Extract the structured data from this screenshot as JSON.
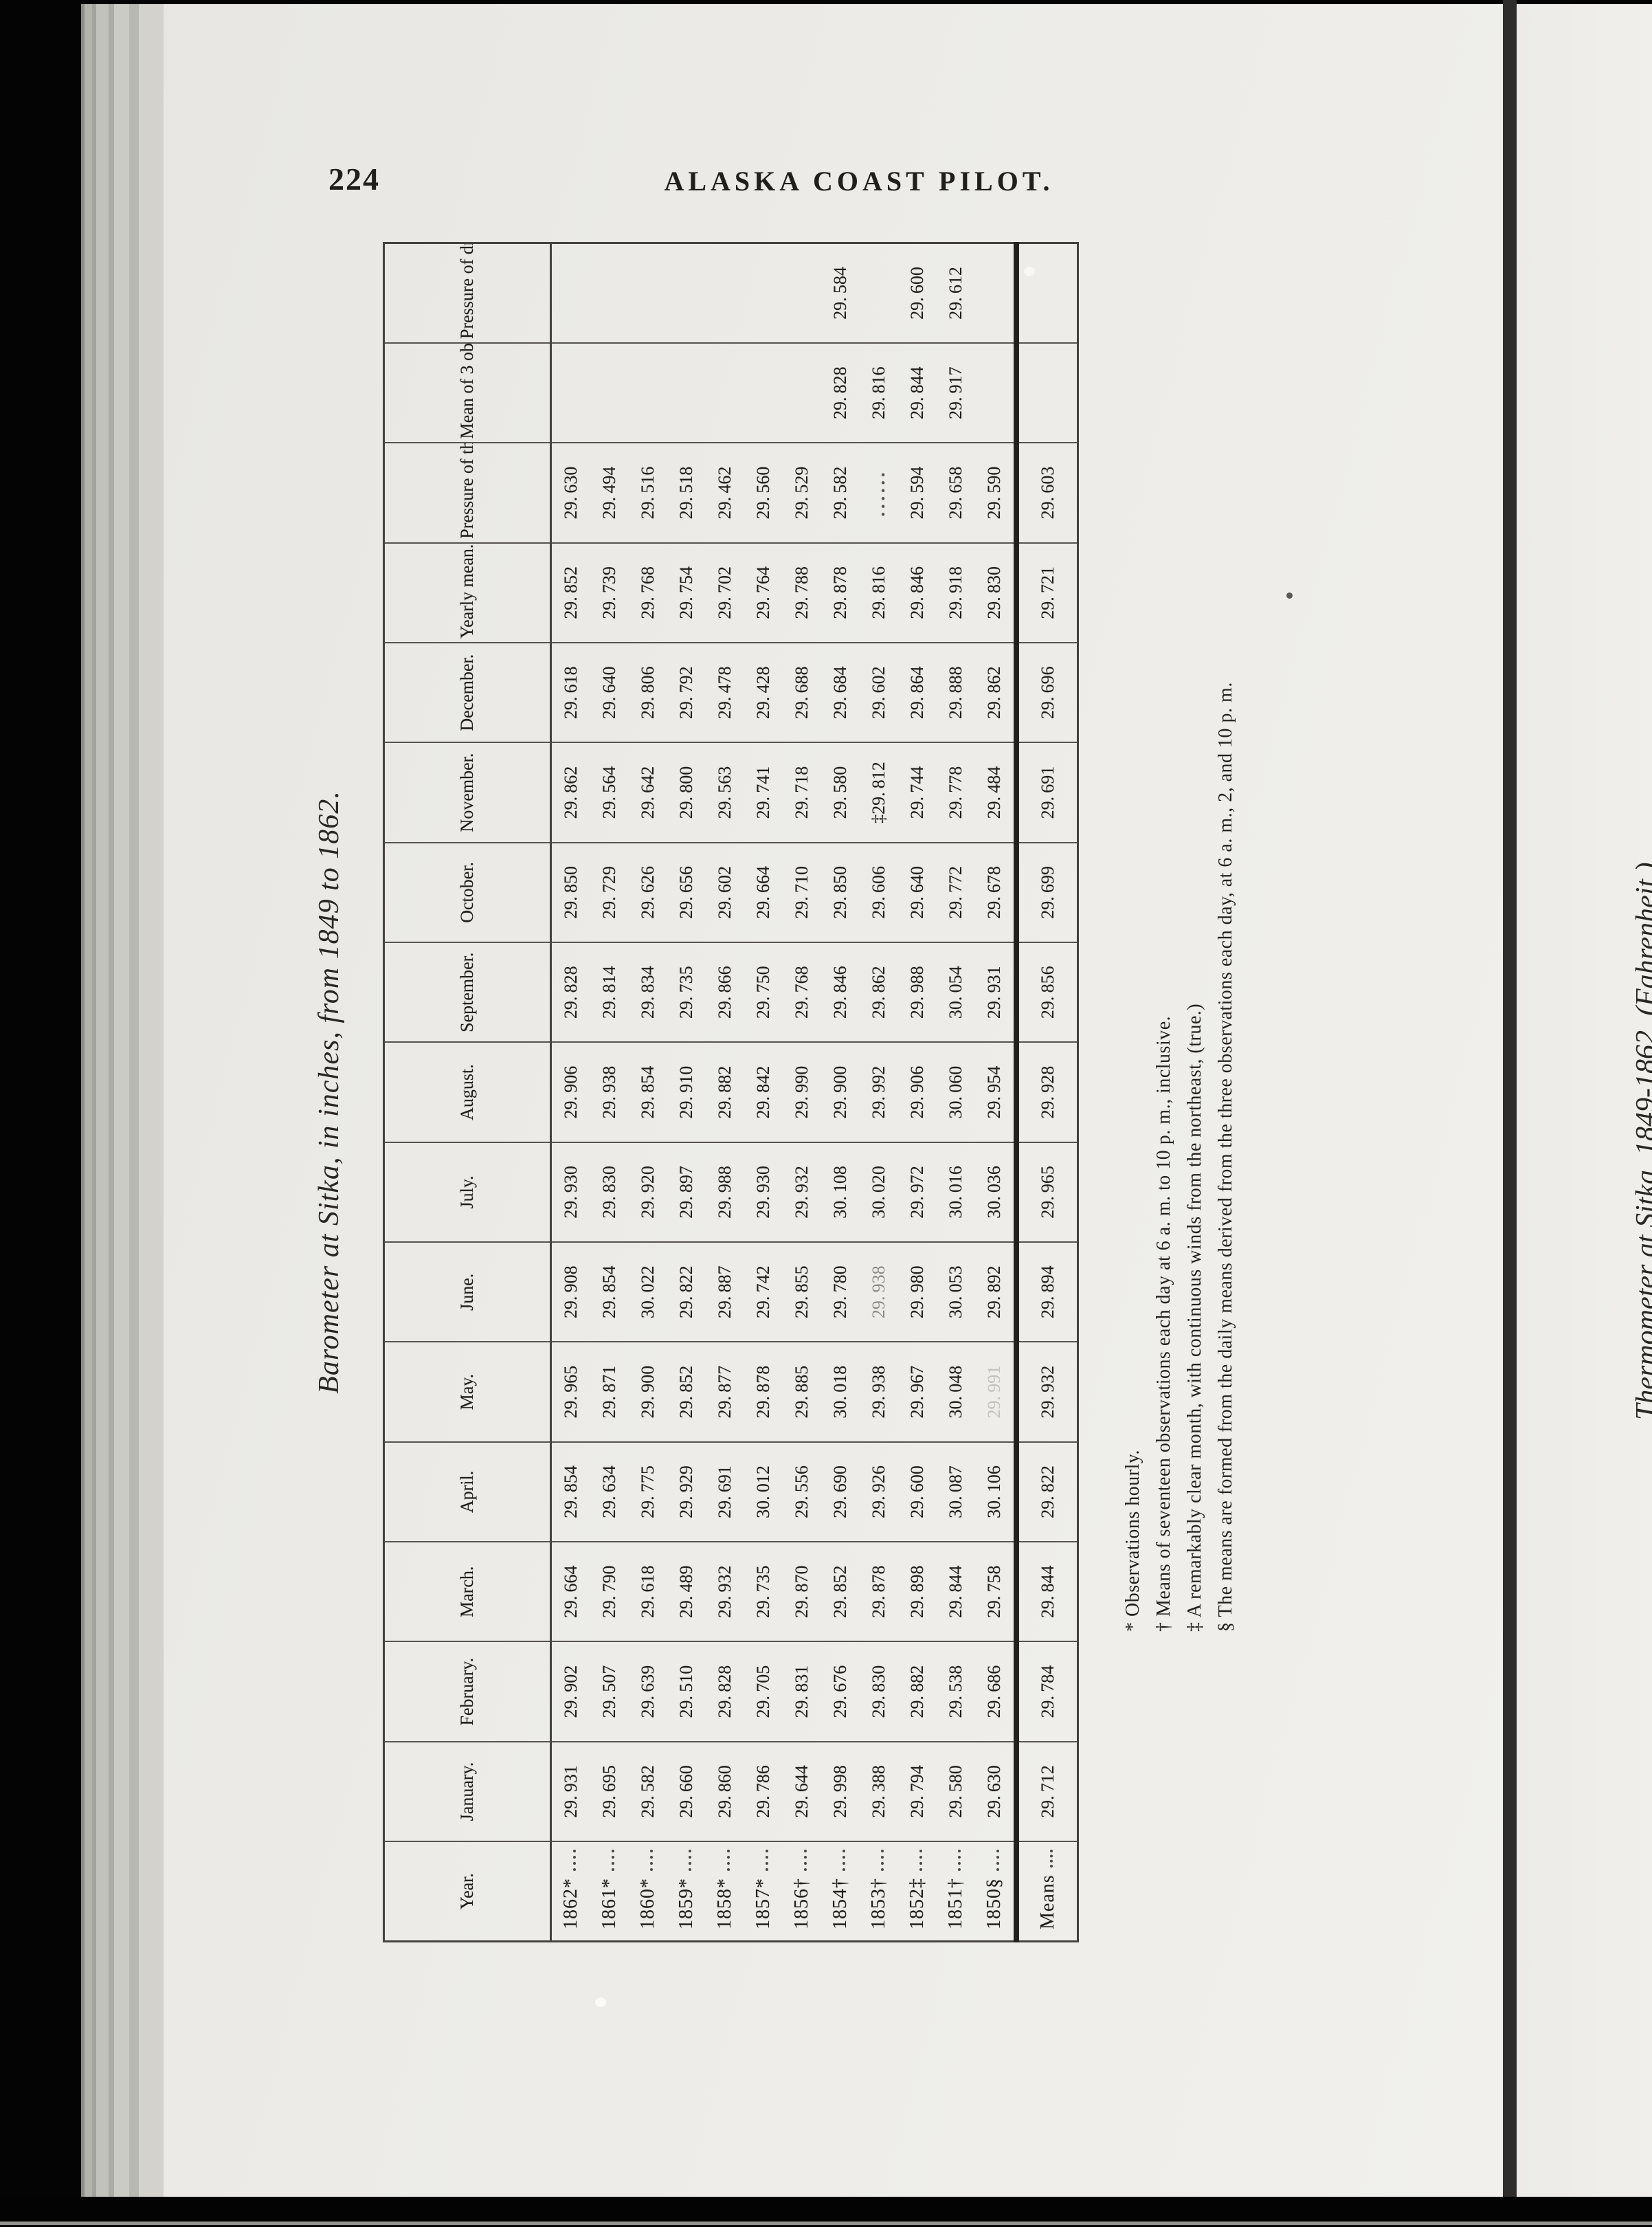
{
  "scan": {
    "page_number": "224",
    "running_title": "ALASKA COAST PILOT.",
    "next_page_title": "Thermometer at Sitka, 1849-1862. (Fahrenheit.)"
  },
  "table": {
    "title": "Barometer at Sitka, in inches, from 1849 to 1862.",
    "columns": [
      "Year.",
      "January.",
      "February.",
      "March.",
      "April.",
      "May.",
      "June.",
      "July.",
      "August.",
      "September.",
      "October.",
      "November.",
      "December.",
      "Yearly mean.",
      "Pressure of the dry air.",
      "Mean of 3 obs., 6 a. m., 2 and 10 p. m.",
      "Pressure of dry air."
    ],
    "rows": [
      {
        "year": "1862*",
        "values": [
          "29.931",
          "29.902",
          "29.664",
          "29.854",
          "29.965",
          "29.908",
          "29.930",
          "29.906",
          "29.828",
          "29.850",
          "29.862",
          "29.618",
          "29.852",
          "29.630",
          "",
          ""
        ]
      },
      {
        "year": "1861*",
        "values": [
          "29.695",
          "29.507",
          "29.790",
          "29.634",
          "29.871",
          "29.854",
          "29.830",
          "29.938",
          "29.814",
          "29.729",
          "29.564",
          "29.640",
          "29.739",
          "29.494",
          "",
          ""
        ]
      },
      {
        "year": "1860*",
        "values": [
          "29.582",
          "29.639",
          "29.618",
          "29.775",
          "29.900",
          "30.022",
          "29.920",
          "29.854",
          "29.834",
          "29.626",
          "29.642",
          "29.806",
          "29.768",
          "29.516",
          "",
          ""
        ]
      },
      {
        "year": "1859*",
        "values": [
          "29.660",
          "29.510",
          "29.489",
          "29.929",
          "29.852",
          "29.822",
          "29.897",
          "29.910",
          "29.735",
          "29.656",
          "29.800",
          "29.792",
          "29.754",
          "29.518",
          "",
          ""
        ]
      },
      {
        "year": "1858*",
        "values": [
          "29.860",
          "29.828",
          "29.932",
          "29.691",
          "29.877",
          "29.887",
          "29.988",
          "29.882",
          "29.866",
          "29.602",
          "29.563",
          "29.478",
          "29.702",
          "29.462",
          "",
          ""
        ]
      },
      {
        "year": "1857*",
        "values": [
          "29.786",
          "29.705",
          "29.735",
          "30.012",
          "29.878",
          "29.742",
          "29.930",
          "29.842",
          "29.750",
          "29.664",
          "29.741",
          "29.428",
          "29.764",
          "29.560",
          "",
          ""
        ]
      },
      {
        "year": "1856†",
        "values": [
          "29.644",
          "29.831",
          "29.870",
          "29.556",
          "29.885",
          "29.855",
          "29.932",
          "29.990",
          "29.768",
          "29.710",
          "29.718",
          "29.688",
          "29.788",
          "29.529",
          "",
          ""
        ]
      },
      {
        "year": "1854†",
        "values": [
          "29.998",
          "29.676",
          "29.852",
          "29.690",
          "30.018",
          "29.780",
          "30.108",
          "29.900",
          "29.846",
          "29.850",
          "29.580",
          "29.684",
          "29.878",
          "29.582",
          "29.828",
          "29.584"
        ]
      },
      {
        "year": "1853†",
        "values": [
          "29.388",
          "29.830",
          "29.878",
          "29.926",
          "29.938",
          "29.938",
          "30.020",
          "29.992",
          "29.862",
          "29.606",
          "‡29.812",
          "29.602",
          "29.816",
          "......",
          "29.816",
          ""
        ]
      },
      {
        "year": "1852‡",
        "values": [
          "29.794",
          "29.882",
          "29.898",
          "29.600",
          "29.967",
          "29.980",
          "29.972",
          "29.906",
          "29.988",
          "29.640",
          "29.744",
          "29.864",
          "29.846",
          "29.594",
          "29.844",
          "29.600"
        ]
      },
      {
        "year": "1851†",
        "values": [
          "29.580",
          "29.538",
          "29.844",
          "30.087",
          "30.048",
          "30.053",
          "30.016",
          "30.060",
          "30.054",
          "29.772",
          "29.778",
          "29.888",
          "29.918",
          "29.658",
          "29.917",
          "29.612"
        ]
      },
      {
        "year": "1850§",
        "values": [
          "29.630",
          "29.686",
          "29.758",
          "30.106",
          "29.991",
          "29.892",
          "30.036",
          "29.954",
          "29.931",
          "29.678",
          "29.484",
          "29.862",
          "29.830",
          "29.590",
          "",
          ""
        ]
      }
    ],
    "means_row": {
      "year": "Means",
      "values": [
        "29.712",
        "29.784",
        "29.844",
        "29.822",
        "29.932",
        "29.894",
        "29.965",
        "29.928",
        "29.856",
        "29.699",
        "29.691",
        "29.696",
        "29.721",
        "29.603",
        "",
        ""
      ]
    },
    "faint_cells": [
      {
        "row": 11,
        "col": 4,
        "level": "faint"
      },
      {
        "row": 8,
        "col": 5,
        "level": "dim"
      }
    ],
    "footnotes": [
      "* Observations hourly.",
      "† Means of seventeen observations each day at 6 a. m. to 10 p. m., inclusive.",
      "‡ A remarkably clear month, with continuous winds from the northeast, (true.)",
      "§ The means are formed from the daily means derived from the three observations each day, at 6 a. m., 2, and 10 p. m."
    ]
  }
}
